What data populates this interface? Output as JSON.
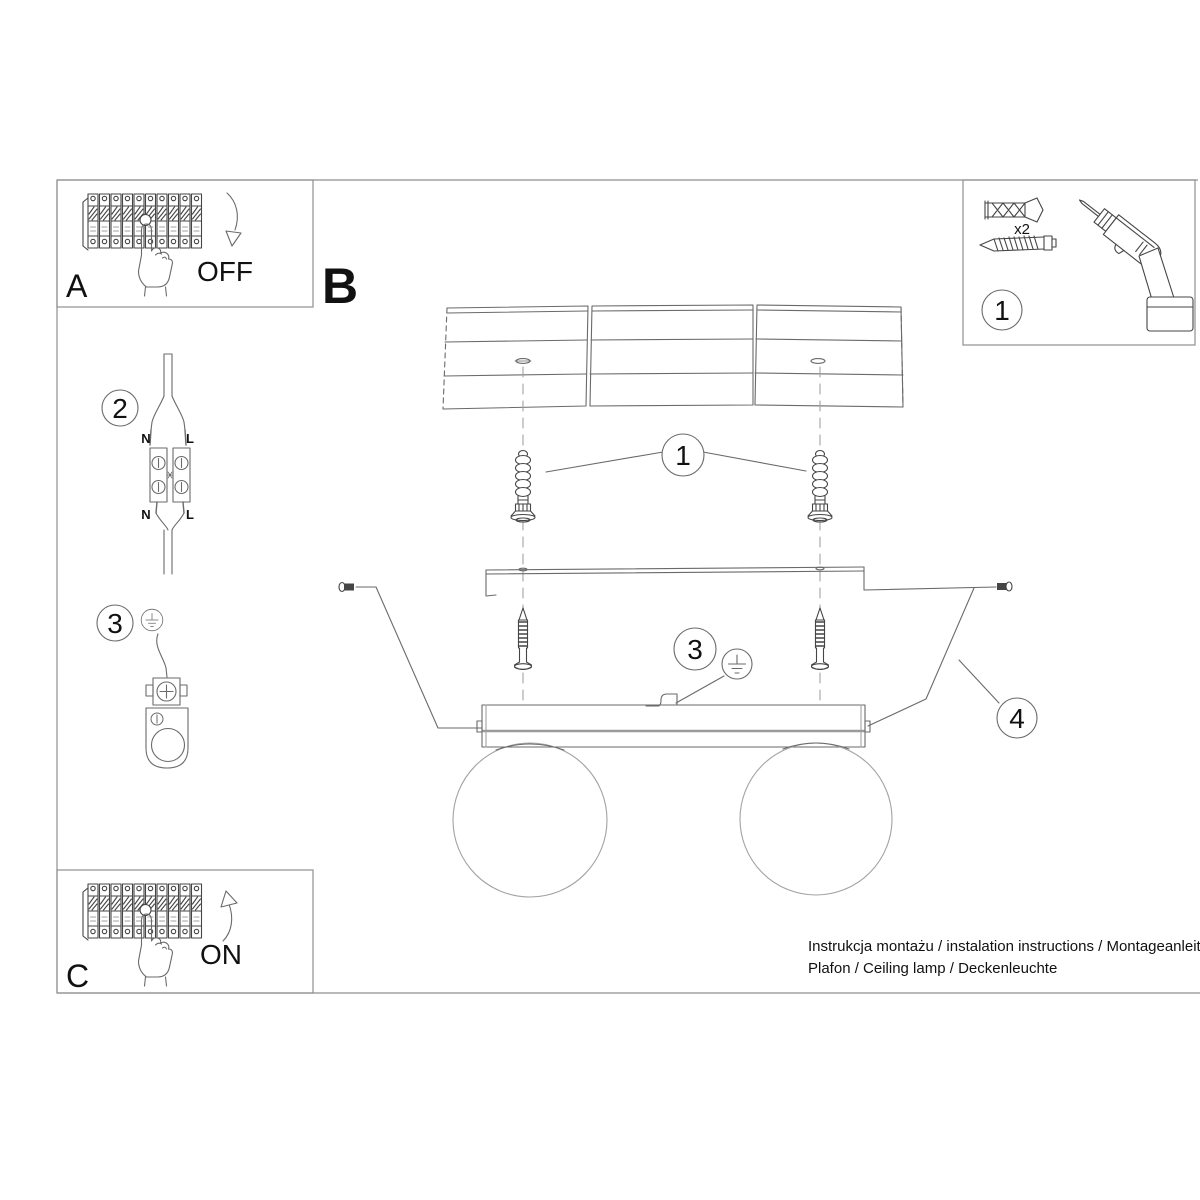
{
  "colors": {
    "background": "#ffffff",
    "frame": "#8f8f8f",
    "line": "#6a6a6a",
    "line_dark": "#454545",
    "line_light": "#a2a2a2",
    "text": "#111111"
  },
  "section_a": {
    "label": "A",
    "switch_action": "OFF"
  },
  "section_b": {
    "label": "B"
  },
  "section_c": {
    "label": "C",
    "switch_action": "ON"
  },
  "steps": {
    "step1": "1",
    "step2": "2",
    "step3": "3",
    "step4": "4"
  },
  "wiring": {
    "neutral": "N",
    "live": "L"
  },
  "parts_box": {
    "anchor_qty": "x2"
  },
  "footer": {
    "line1": "Instrukcja montażu / instalation instructions / Montageanleitung",
    "line2": "Plafon / Ceiling lamp / Deckenleuchte"
  }
}
